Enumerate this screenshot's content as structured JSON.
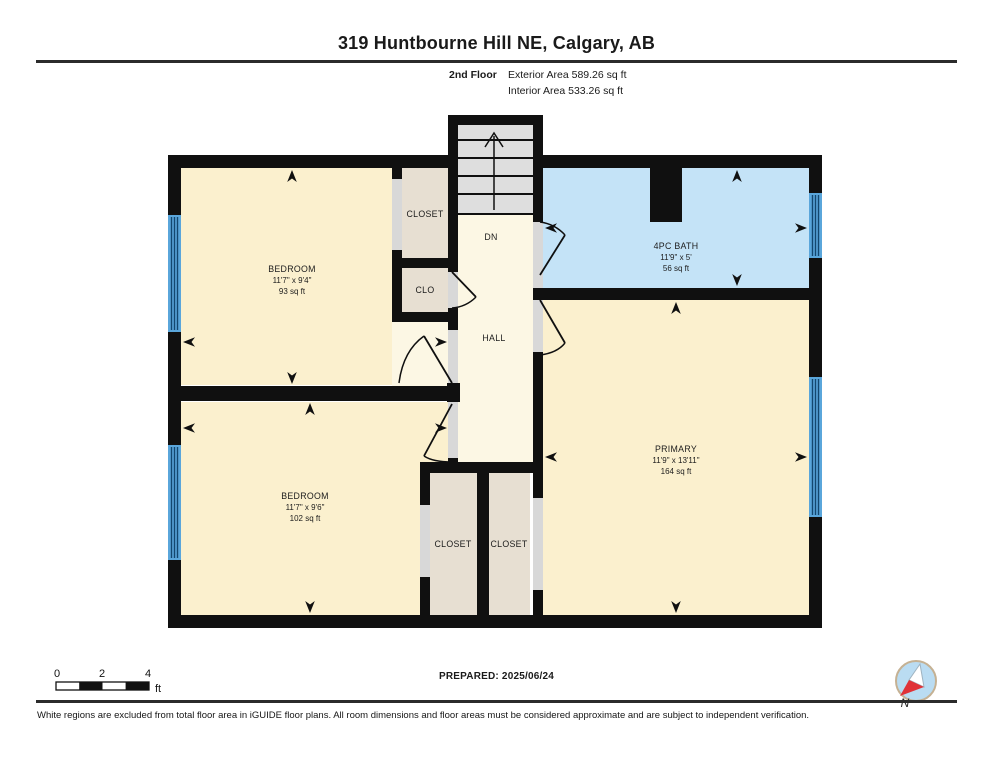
{
  "header": {
    "title": "319 Huntbourne Hill NE, Calgary, AB",
    "floor_label": "2nd Floor",
    "exterior_area": "Exterior Area 589.26 sq ft",
    "interior_area": "Interior Area 533.26 sq ft"
  },
  "rooms": {
    "bedroom_top": {
      "name": "BEDROOM",
      "dims": "11'7\" x 9'4\"",
      "area": "93 sq ft"
    },
    "closet_top": {
      "name": "CLOSET"
    },
    "clo": {
      "name": "CLO"
    },
    "stairs": {
      "name": "DN"
    },
    "hall": {
      "name": "HALL"
    },
    "bath": {
      "name": "4PC BATH",
      "dims": "11'9\" x 5'",
      "area": "56 sq ft"
    },
    "primary": {
      "name": "PRIMARY",
      "dims": "11'9\" x 13'11\"",
      "area": "164 sq ft"
    },
    "bedroom_bottom": {
      "name": "BEDROOM",
      "dims": "11'7\" x 9'6\"",
      "area": "102 sq ft"
    },
    "closet_bottom_left": {
      "name": "CLOSET"
    },
    "closet_bottom_right": {
      "name": "CLOSET"
    }
  },
  "scale_bar": {
    "tick0": "0",
    "tick2": "2",
    "tick4": "4",
    "unit": "ft"
  },
  "footer": {
    "prepared": "PREPARED: 2025/06/24",
    "compass_label": "N",
    "disclaimer": "White regions are excluded from total floor area in iGUIDE floor plans. All room dimensions and floor areas must be considered approximate and are subject to independent verification."
  },
  "colors": {
    "walls": "#101010",
    "room": "#FBF0CE",
    "hall": "#FCF7E4",
    "closet": "#E7DFD2",
    "bath": "#C4E3F7",
    "stairs": "#DEDEDE",
    "window": "#5AA6DB",
    "door_gap": "#D8D8D8",
    "compass_red": "#E03238",
    "compass_circle": "#BADCF2"
  }
}
